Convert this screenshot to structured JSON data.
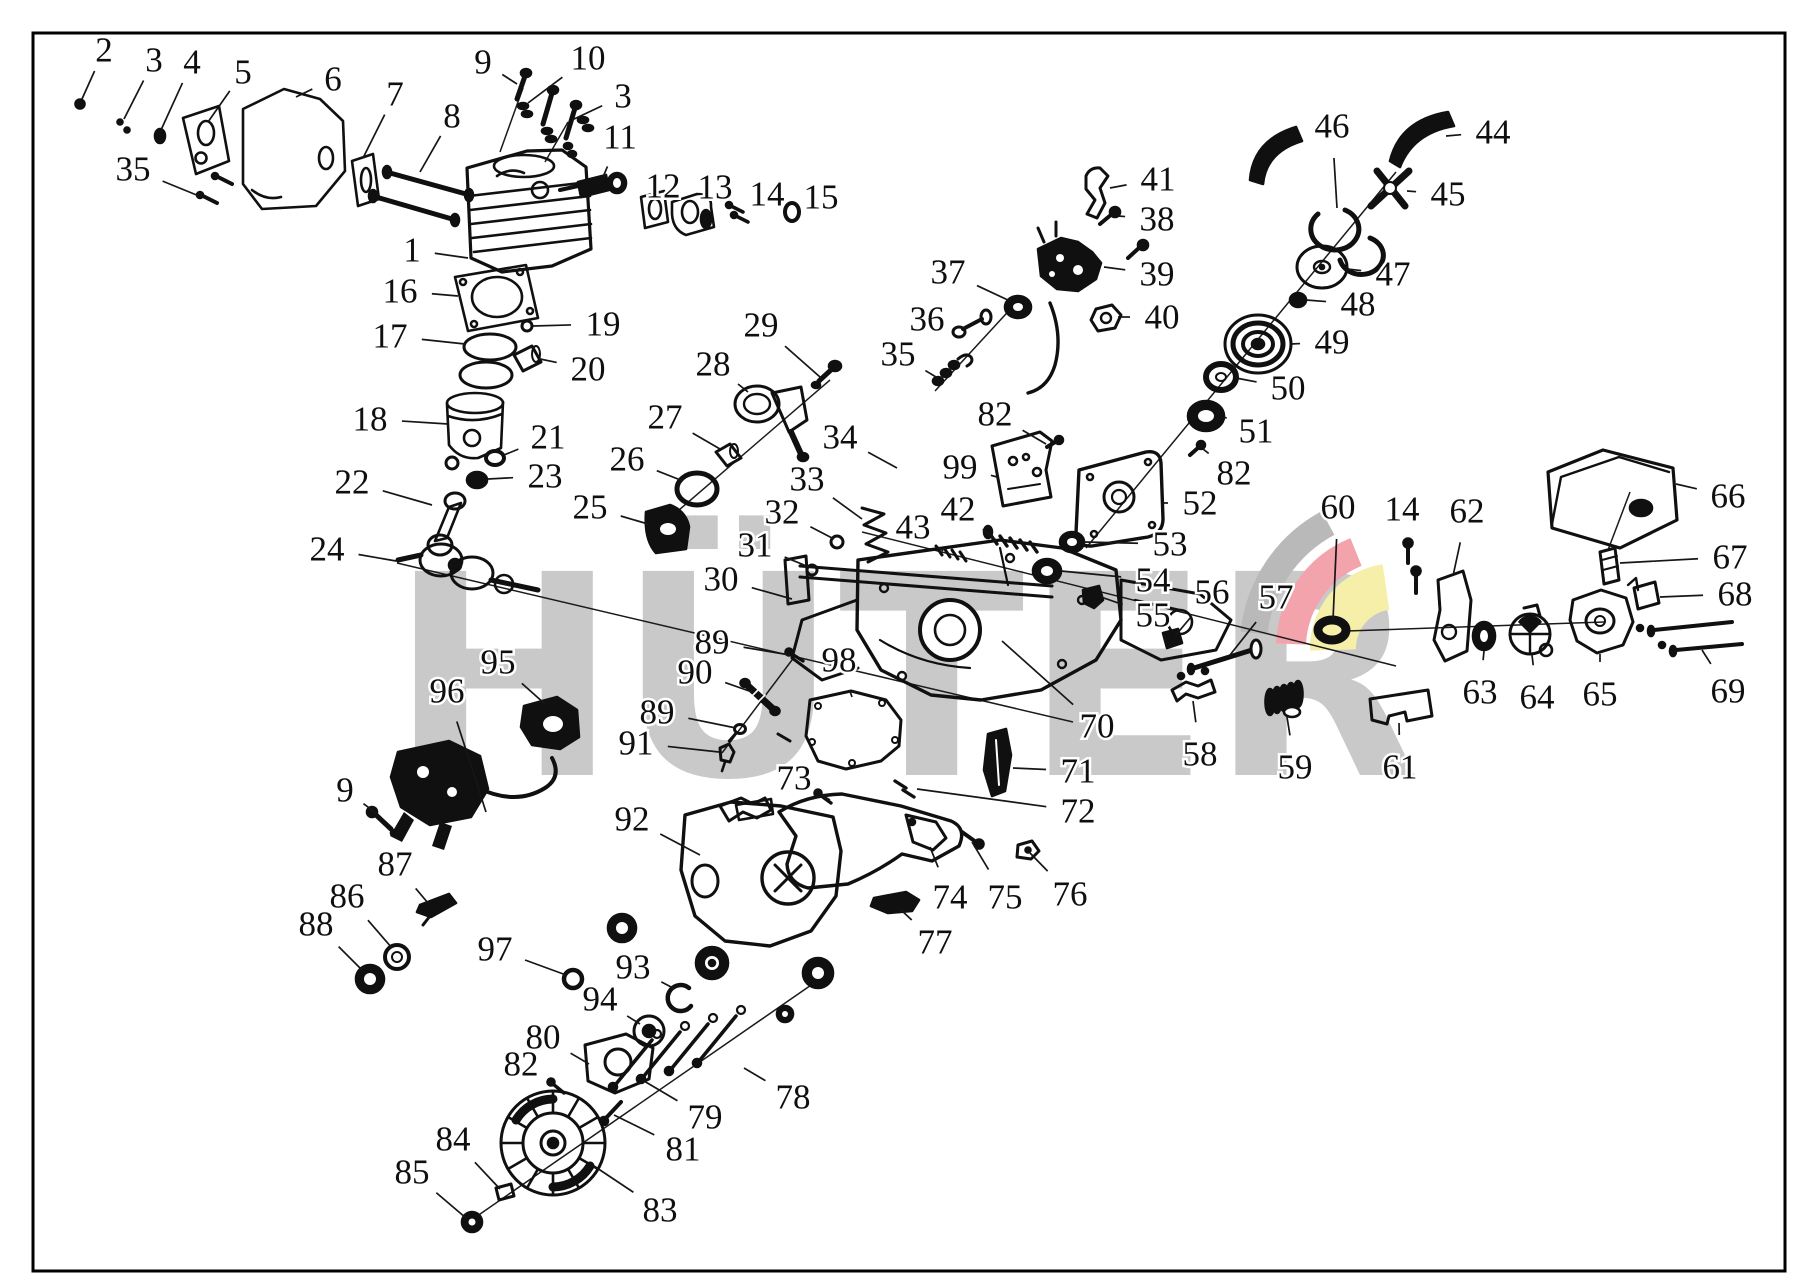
{
  "meta": {
    "width": 1809,
    "height": 1283,
    "background": "#ffffff",
    "frame_color": "#000000",
    "line_color": "#101010"
  },
  "brand": {
    "watermark_text": "HÜTER",
    "watermark_color": "#c9c9c9",
    "logo_band_colors": [
      "#b9b9b9",
      "#f2a3ab",
      "#f6efaa"
    ]
  },
  "diagram": {
    "type": "exploded-parts-diagram",
    "subject": "chainsaw engine parts",
    "labels": [
      {
        "t": "2",
        "x": 104,
        "y": 50,
        "tx": 82,
        "ty": 99
      },
      {
        "t": "3",
        "x": 154,
        "y": 60,
        "tx": 124,
        "ty": 119
      },
      {
        "t": "4",
        "x": 192,
        "y": 62,
        "tx": 161,
        "ty": 130
      },
      {
        "t": "5",
        "x": 243,
        "y": 72,
        "tx": 208,
        "ty": 122
      },
      {
        "t": "6",
        "x": 333,
        "y": 79,
        "tx": 296,
        "ty": 97
      },
      {
        "t": "7",
        "x": 395,
        "y": 94,
        "tx": 363,
        "ty": 158
      },
      {
        "t": "8",
        "x": 452,
        "y": 116,
        "tx": 420,
        "ty": 172
      },
      {
        "t": "35",
        "x": 133,
        "y": 169,
        "tx": 199,
        "ty": 196
      },
      {
        "t": "9",
        "x": 483,
        "y": 62,
        "tx": 517,
        "ty": 84
      },
      {
        "t": "10",
        "x": 588,
        "y": 58,
        "tx": 528,
        "ty": 103
      },
      {
        "t": "3",
        "x": 623,
        "y": 96,
        "tx": 572,
        "ty": 120
      },
      {
        "t": "11",
        "x": 620,
        "y": 137,
        "tx": 603,
        "ty": 177
      },
      {
        "t": "12",
        "x": 663,
        "y": 186,
        "tx": 654,
        "ty": 203
      },
      {
        "t": "13",
        "x": 715,
        "y": 187,
        "tx": 700,
        "ty": 207
      },
      {
        "t": "14",
        "x": 767,
        "y": 194,
        "tx": 744,
        "ty": 209
      },
      {
        "t": "15",
        "x": 821,
        "y": 197,
        "tx": 797,
        "ty": 209
      },
      {
        "t": "1",
        "x": 412,
        "y": 250,
        "tx": 468,
        "ty": 258
      },
      {
        "t": "16",
        "x": 400,
        "y": 291,
        "tx": 458,
        "ty": 296
      },
      {
        "t": "17",
        "x": 390,
        "y": 336,
        "tx": 465,
        "ty": 344
      },
      {
        "t": "19",
        "x": 603,
        "y": 324,
        "tx": 533,
        "ty": 326
      },
      {
        "t": "20",
        "x": 588,
        "y": 369,
        "tx": 540,
        "ty": 359
      },
      {
        "t": "18",
        "x": 370,
        "y": 419,
        "tx": 448,
        "ty": 424
      },
      {
        "t": "21",
        "x": 548,
        "y": 437,
        "tx": 504,
        "ty": 455
      },
      {
        "t": "23",
        "x": 545,
        "y": 476,
        "tx": 488,
        "ty": 479
      },
      {
        "t": "22",
        "x": 352,
        "y": 482,
        "tx": 432,
        "ty": 505
      },
      {
        "t": "24",
        "x": 327,
        "y": 549,
        "tx": 396,
        "ty": 561
      },
      {
        "t": "25",
        "x": 590,
        "y": 507,
        "tx": 648,
        "ty": 524
      },
      {
        "t": "26",
        "x": 627,
        "y": 459,
        "tx": 683,
        "ty": 481
      },
      {
        "t": "27",
        "x": 665,
        "y": 417,
        "tx": 720,
        "ty": 449
      },
      {
        "t": "28",
        "x": 713,
        "y": 364,
        "tx": 748,
        "ty": 392
      },
      {
        "t": "29",
        "x": 761,
        "y": 325,
        "tx": 820,
        "ty": 377
      },
      {
        "t": "34",
        "x": 840,
        "y": 437,
        "tx": 897,
        "ty": 468
      },
      {
        "t": "33",
        "x": 807,
        "y": 479,
        "tx": 862,
        "ty": 519
      },
      {
        "t": "32",
        "x": 782,
        "y": 512,
        "tx": 834,
        "ty": 539
      },
      {
        "t": "31",
        "x": 755,
        "y": 545,
        "tx": 809,
        "ty": 567
      },
      {
        "t": "30",
        "x": 721,
        "y": 579,
        "tx": 792,
        "ty": 599
      },
      {
        "t": "43",
        "x": 913,
        "y": 527,
        "tx": 943,
        "ty": 551
      },
      {
        "t": "42",
        "x": 958,
        "y": 509,
        "tx": 996,
        "ty": 540
      },
      {
        "t": "37",
        "x": 948,
        "y": 272,
        "tx": 1010,
        "ty": 301
      },
      {
        "t": "36",
        "x": 927,
        "y": 319,
        "tx": 966,
        "ty": 328
      },
      {
        "t": "35",
        "x": 898,
        "y": 354,
        "tx": 936,
        "ty": 377
      },
      {
        "t": "41",
        "x": 1158,
        "y": 179,
        "tx": 1110,
        "ty": 188
      },
      {
        "t": "38",
        "x": 1157,
        "y": 219,
        "tx": 1118,
        "ty": 216
      },
      {
        "t": "39",
        "x": 1157,
        "y": 274,
        "tx": 1104,
        "ty": 267
      },
      {
        "t": "40",
        "x": 1162,
        "y": 317,
        "tx": 1118,
        "ty": 317
      },
      {
        "t": "82",
        "x": 995,
        "y": 414,
        "tx": 1046,
        "ty": 444
      },
      {
        "t": "99",
        "x": 960,
        "y": 467,
        "tx": 997,
        "ty": 477
      },
      {
        "t": "46",
        "x": 1332,
        "y": 126,
        "tx": 1337,
        "ty": 208
      },
      {
        "t": "44",
        "x": 1493,
        "y": 132,
        "tx": 1446,
        "ty": 136
      },
      {
        "t": "45",
        "x": 1448,
        "y": 194,
        "tx": 1407,
        "ty": 191
      },
      {
        "t": "47",
        "x": 1393,
        "y": 274,
        "tx": 1347,
        "ty": 269
      },
      {
        "t": "48",
        "x": 1358,
        "y": 304,
        "tx": 1306,
        "ty": 300
      },
      {
        "t": "49",
        "x": 1332,
        "y": 342,
        "tx": 1291,
        "ty": 344
      },
      {
        "t": "50",
        "x": 1288,
        "y": 388,
        "tx": 1236,
        "ty": 378
      },
      {
        "t": "51",
        "x": 1256,
        "y": 431,
        "tx": 1224,
        "ty": 417
      },
      {
        "t": "82",
        "x": 1234,
        "y": 473,
        "tx": 1203,
        "ty": 449
      },
      {
        "t": "52",
        "x": 1200,
        "y": 503,
        "tx": 1163,
        "ty": 503
      },
      {
        "t": "53",
        "x": 1170,
        "y": 544,
        "tx": 1084,
        "ty": 542
      },
      {
        "t": "54",
        "x": 1153,
        "y": 580,
        "tx": 1061,
        "ty": 571
      },
      {
        "t": "55",
        "x": 1153,
        "y": 615,
        "tx": 1101,
        "ty": 597
      },
      {
        "t": "56",
        "x": 1212,
        "y": 592,
        "tx": 1175,
        "ty": 636
      },
      {
        "t": "57",
        "x": 1276,
        "y": 597,
        "tx": 1230,
        "ty": 655
      },
      {
        "t": "60",
        "x": 1338,
        "y": 507,
        "tx": 1333,
        "ty": 620
      },
      {
        "t": "14",
        "x": 1402,
        "y": 509,
        "tx": 1409,
        "ty": 542
      },
      {
        "t": "62",
        "x": 1467,
        "y": 511,
        "tx": 1453,
        "ty": 576
      },
      {
        "t": "66",
        "x": 1728,
        "y": 496,
        "tx": 1676,
        "ty": 484
      },
      {
        "t": "67",
        "x": 1730,
        "y": 557,
        "tx": 1620,
        "ty": 563
      },
      {
        "t": "68",
        "x": 1735,
        "y": 594,
        "tx": 1660,
        "ty": 597
      },
      {
        "t": "69",
        "x": 1728,
        "y": 691,
        "tx": 1702,
        "ty": 650
      },
      {
        "t": "63",
        "x": 1480,
        "y": 692,
        "tx": 1484,
        "ty": 651
      },
      {
        "t": "64",
        "x": 1537,
        "y": 697,
        "tx": 1532,
        "ty": 655
      },
      {
        "t": "65",
        "x": 1600,
        "y": 694,
        "tx": 1600,
        "ty": 654
      },
      {
        "t": "61",
        "x": 1400,
        "y": 767,
        "tx": 1399,
        "ty": 723
      },
      {
        "t": "58",
        "x": 1200,
        "y": 754,
        "tx": 1193,
        "ty": 701
      },
      {
        "t": "59",
        "x": 1295,
        "y": 767,
        "tx": 1287,
        "ty": 717
      },
      {
        "t": "70",
        "x": 1097,
        "y": 726,
        "tx": 1002,
        "ty": 641
      },
      {
        "t": "71",
        "x": 1078,
        "y": 771,
        "tx": 1013,
        "ty": 768
      },
      {
        "t": "72",
        "x": 1078,
        "y": 811,
        "tx": 917,
        "ty": 789
      },
      {
        "t": "89",
        "x": 712,
        "y": 642,
        "tx": 790,
        "ty": 655
      },
      {
        "t": "90",
        "x": 695,
        "y": 672,
        "tx": 752,
        "ty": 692
      },
      {
        "t": "98",
        "x": 839,
        "y": 660,
        "tx": 852,
        "ty": 697
      },
      {
        "t": "89",
        "x": 657,
        "y": 712,
        "tx": 736,
        "ty": 728
      },
      {
        "t": "91",
        "x": 636,
        "y": 743,
        "tx": 719,
        "ty": 752
      },
      {
        "t": "73",
        "x": 794,
        "y": 778,
        "tx": 830,
        "ty": 800
      },
      {
        "t": "92",
        "x": 632,
        "y": 819,
        "tx": 700,
        "ty": 855
      },
      {
        "t": "95",
        "x": 498,
        "y": 662,
        "tx": 545,
        "ty": 704
      },
      {
        "t": "96",
        "x": 447,
        "y": 691,
        "tx": 486,
        "ty": 812
      },
      {
        "t": "9",
        "x": 345,
        "y": 790,
        "tx": 376,
        "ty": 813
      },
      {
        "t": "87",
        "x": 395,
        "y": 864,
        "tx": 428,
        "ty": 903
      },
      {
        "t": "86",
        "x": 347,
        "y": 896,
        "tx": 392,
        "ty": 948
      },
      {
        "t": "88",
        "x": 316,
        "y": 924,
        "tx": 362,
        "ty": 970
      },
      {
        "t": "97",
        "x": 495,
        "y": 949,
        "tx": 566,
        "ty": 975
      },
      {
        "t": "93",
        "x": 633,
        "y": 967,
        "tx": 673,
        "ty": 988
      },
      {
        "t": "94",
        "x": 600,
        "y": 999,
        "tx": 640,
        "ty": 1024
      },
      {
        "t": "80",
        "x": 543,
        "y": 1037,
        "tx": 589,
        "ty": 1064
      },
      {
        "t": "82",
        "x": 521,
        "y": 1064,
        "tx": 553,
        "ty": 1085
      },
      {
        "t": "78",
        "x": 793,
        "y": 1097,
        "tx": 744,
        "ty": 1068
      },
      {
        "t": "79",
        "x": 705,
        "y": 1117,
        "tx": 644,
        "ty": 1081
      },
      {
        "t": "81",
        "x": 683,
        "y": 1149,
        "tx": 614,
        "ty": 1115
      },
      {
        "t": "84",
        "x": 453,
        "y": 1139,
        "tx": 500,
        "ty": 1189
      },
      {
        "t": "85",
        "x": 412,
        "y": 1172,
        "tx": 466,
        "ty": 1218
      },
      {
        "t": "83",
        "x": 660,
        "y": 1210,
        "tx": 594,
        "ty": 1166
      },
      {
        "t": "74",
        "x": 950,
        "y": 897,
        "tx": 930,
        "ty": 847
      },
      {
        "t": "75",
        "x": 1005,
        "y": 897,
        "tx": 972,
        "ty": 842
      },
      {
        "t": "76",
        "x": 1070,
        "y": 894,
        "tx": 1030,
        "ty": 853
      },
      {
        "t": "77",
        "x": 935,
        "y": 942,
        "tx": 900,
        "ty": 909
      }
    ],
    "axes": [
      {
        "x1": 397,
        "y1": 563,
        "x2": 1073,
        "y2": 722
      },
      {
        "x1": 862,
        "y1": 532,
        "x2": 1396,
        "y2": 666
      },
      {
        "x1": 650,
        "y1": 535,
        "x2": 830,
        "y2": 380
      },
      {
        "x1": 1396,
        "y1": 172,
        "x2": 1086,
        "y2": 548
      },
      {
        "x1": 470,
        "y1": 1221,
        "x2": 830,
        "y2": 972
      },
      {
        "x1": 935,
        "y1": 391,
        "x2": 1016,
        "y2": 303
      },
      {
        "x1": 795,
        "y1": 656,
        "x2": 722,
        "y2": 753
      },
      {
        "x1": 1347,
        "y1": 631,
        "x2": 1604,
        "y2": 622
      },
      {
        "x1": 1608,
        "y1": 550,
        "x2": 1630,
        "y2": 492
      },
      {
        "x1": 523,
        "y1": 88,
        "x2": 500,
        "y2": 152
      },
      {
        "x1": 568,
        "y1": 122,
        "x2": 545,
        "y2": 162
      }
    ]
  }
}
